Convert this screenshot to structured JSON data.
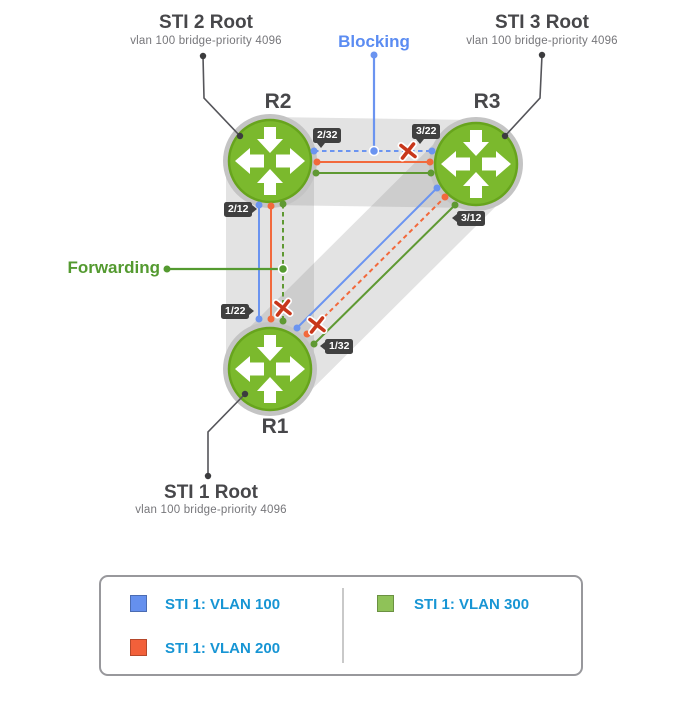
{
  "callouts": {
    "sti2_title": "STI 2 Root",
    "sti2_subtitle": "vlan 100 bridge-priority 4096",
    "sti3_title": "STI 3 Root",
    "sti3_subtitle": "vlan 100 bridge-priority 4096",
    "sti1_title": "STI 1 Root",
    "sti1_subtitle": "vlan 100 bridge-priority 4096",
    "blocking_label": "Blocking",
    "forwarding_label": "Forwarding"
  },
  "routers": [
    {
      "id": "R2",
      "label": "R2"
    },
    {
      "id": "R3",
      "label": "R3"
    },
    {
      "id": "R1",
      "label": "R1"
    }
  ],
  "ports": [
    {
      "label": "2/32",
      "router": "R2"
    },
    {
      "label": "3/22",
      "router": "R3"
    },
    {
      "label": "2/12",
      "router": "R2"
    },
    {
      "label": "1/22",
      "router": "R1"
    },
    {
      "label": "3/12",
      "router": "R3"
    },
    {
      "label": "1/32",
      "router": "R1"
    }
  ],
  "links": [
    {
      "between": [
        "R2",
        "R3"
      ],
      "vlans": [
        {
          "vlan": "VLAN 100",
          "color": "#6b94f0",
          "state": "blocking",
          "style": "dashed",
          "blocked_mark": true
        },
        {
          "vlan": "VLAN 200",
          "color": "#f2693c",
          "state": "forwarding",
          "style": "solid",
          "blocked_mark": false
        },
        {
          "vlan": "VLAN 300",
          "color": "#5f9933",
          "state": "forwarding",
          "style": "solid",
          "blocked_mark": false
        }
      ]
    },
    {
      "between": [
        "R2",
        "R1"
      ],
      "vlans": [
        {
          "vlan": "VLAN 100",
          "color": "#6b94f0",
          "state": "forwarding",
          "style": "solid",
          "blocked_mark": false
        },
        {
          "vlan": "VLAN 200",
          "color": "#f2693c",
          "state": "forwarding",
          "style": "solid",
          "blocked_mark": false
        },
        {
          "vlan": "VLAN 300",
          "color": "#5f9933",
          "state": "blocking",
          "style": "dashed",
          "blocked_mark": true
        }
      ]
    },
    {
      "between": [
        "R1",
        "R3"
      ],
      "vlans": [
        {
          "vlan": "VLAN 100",
          "color": "#6b94f0",
          "state": "forwarding",
          "style": "solid",
          "blocked_mark": false
        },
        {
          "vlan": "VLAN 200",
          "color": "#f2693c",
          "state": "blocking",
          "style": "dashed",
          "blocked_mark": true
        },
        {
          "vlan": "VLAN 300",
          "color": "#5f9933",
          "state": "forwarding",
          "style": "solid",
          "blocked_mark": false
        }
      ]
    }
  ],
  "legend": {
    "items": [
      {
        "label": "STI 1: VLAN 100",
        "color": "#6590ee"
      },
      {
        "label": "STI 1: VLAN 200",
        "color": "#f2603a"
      },
      {
        "label": "STI 1: VLAN 300",
        "color": "#8fc258"
      }
    ]
  },
  "colors": {
    "router_green": "#7bb92d",
    "router_border": "#67a41d",
    "vlan100_blue": "#6b94f0",
    "vlan200_orange": "#f2693c",
    "vlan300_green": "#5f9933",
    "blocked_x_red": "#c8371b",
    "legend_text_blue": "#1795d4",
    "badge_bg": "#404040",
    "title_gray": "#47474a"
  }
}
